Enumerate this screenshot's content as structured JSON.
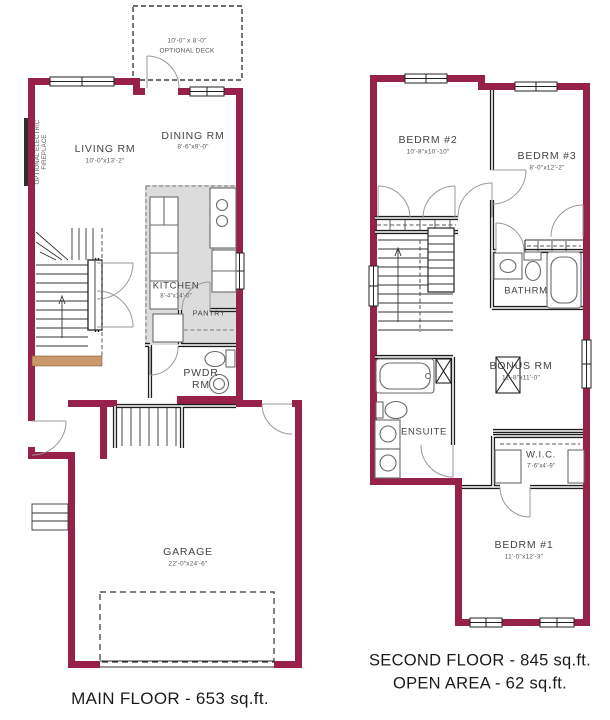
{
  "palette": {
    "wall": "#97214b",
    "kitchen": "#dcdcdc",
    "landing": "#c9996b",
    "thin": "#1d1d1d",
    "fixture": "#6a6a6a",
    "label": "#444444",
    "caption": "#1b1b1b"
  },
  "main_floor": {
    "caption": "MAIN FLOOR - 653 sq.ft.",
    "deck": {
      "dims": "10'-0\" x 8'-0\"",
      "label": "OPTIONAL DECK"
    },
    "fireplace_note": "OPTIONAL ELECTRIC FIREPLACE",
    "living": {
      "name": "LIVING RM",
      "dims": "10'-0\"x13'-2\""
    },
    "dining": {
      "name": "DINING RM",
      "dims": "8'-6\"x9'-0\""
    },
    "kitchen": {
      "name": "KITCHEN",
      "dims": "8'-4\"x14'-0\""
    },
    "pantry": {
      "name": "PANTRY"
    },
    "powder": {
      "name": "PWDR RM"
    },
    "garage": {
      "name": "GARAGE",
      "dims": "22'-0\"x24'-6\""
    }
  },
  "second_floor": {
    "caption_line1": "SECOND FLOOR - 845 sq.ft.",
    "caption_line2": "OPEN AREA - 62 sq.ft.",
    "bedroom2": {
      "name": "BEDRM #2",
      "dims": "10'-8\"x10'-10\""
    },
    "bedroom3": {
      "name": "BEDRM #3",
      "dims": "8'-0\"x12'-2\""
    },
    "bathroom": {
      "name": "BATHRM"
    },
    "bonus": {
      "name": "BONUS RM",
      "dims": "11'-8\"x11'-0\""
    },
    "ensuite": {
      "name": "ENSUITE"
    },
    "wic": {
      "name": "W.I.C.",
      "dims": "7'-6\"x4'-9\""
    },
    "bedroom1": {
      "name": "BEDRM #1",
      "dims": "11'-0\"x12'-3\""
    }
  }
}
